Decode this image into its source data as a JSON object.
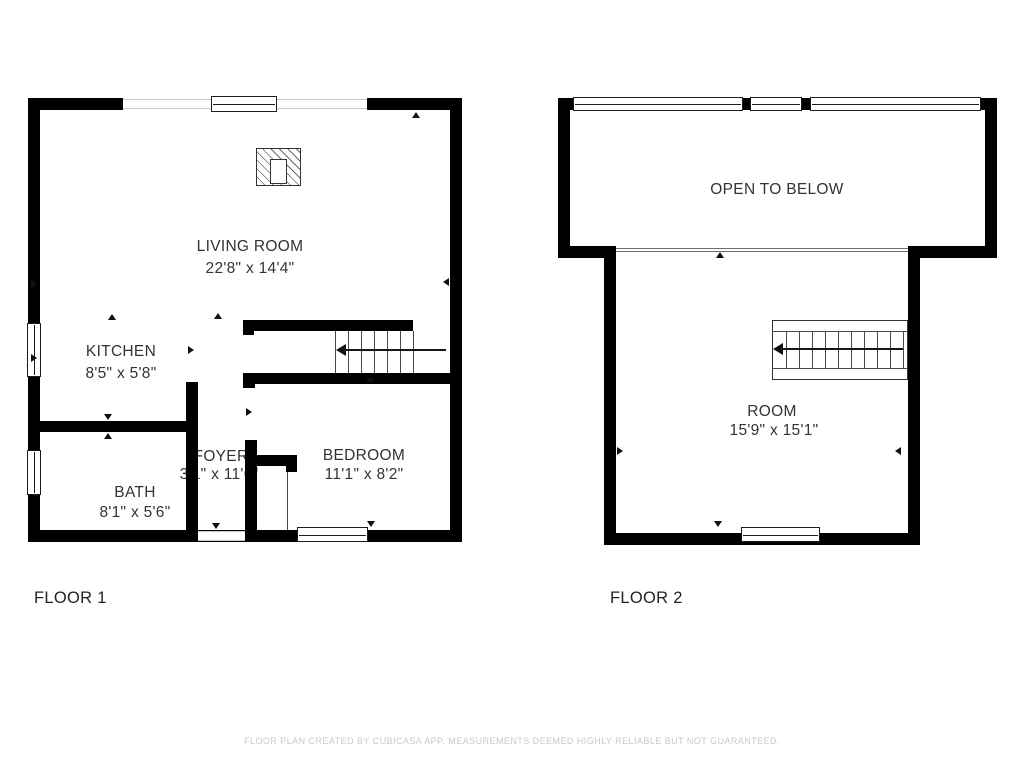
{
  "footer": {
    "disclaimer": "FLOOR PLAN CREATED BY CUBICASA APP. MEASUREMENTS DEEMED HIGHLY RELIABLE BUT NOT GUARANTEED."
  },
  "floor1": {
    "label": "FLOOR 1",
    "rooms": {
      "living_room": {
        "name": "LIVING ROOM",
        "dims": "22'8\" x 14'4\""
      },
      "kitchen": {
        "name": "KITCHEN",
        "dims": "8'5\" x 5'8\""
      },
      "bath": {
        "name": "BATH",
        "dims": "8'1\" x 5'6\""
      },
      "foyer": {
        "name": "FOYER",
        "dims": "3'1\" x 11'6\""
      },
      "bedroom": {
        "name": "BEDROOM",
        "dims": "11'1\" x 8'2\""
      }
    }
  },
  "floor2": {
    "label": "FLOOR 2",
    "rooms": {
      "open_to_below": {
        "name": "OPEN TO BELOW"
      },
      "room": {
        "name": "ROOM",
        "dims": "15'9\" x 15'1\""
      }
    }
  },
  "colors": {
    "wall": "#000000",
    "thin_line": "#4a4a4a",
    "label_text": "#333333",
    "disclaimer_text": "#c9c9c9"
  }
}
